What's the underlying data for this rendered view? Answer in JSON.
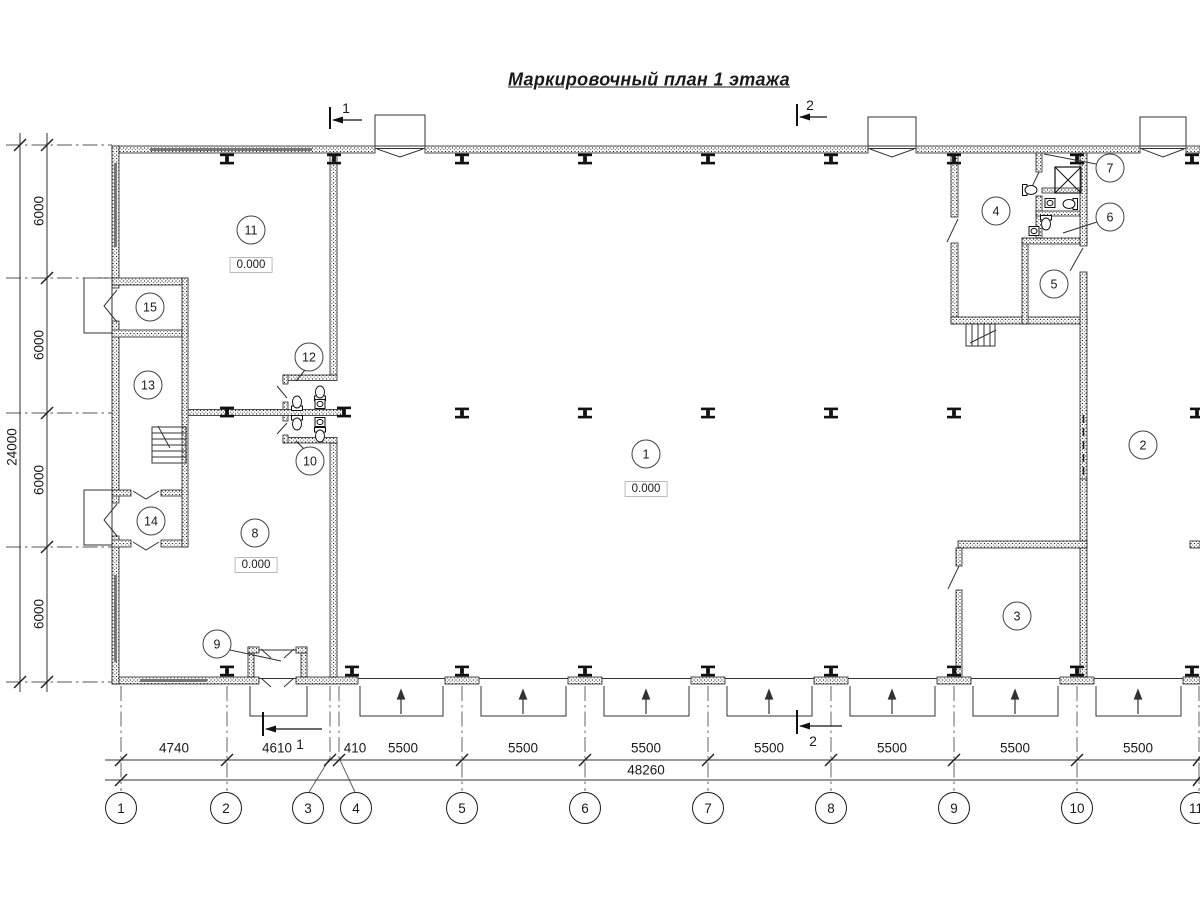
{
  "title": "Маркировочный план 1 этажа",
  "rooms": [
    {
      "number": "1",
      "level": "0.000"
    },
    {
      "number": "2"
    },
    {
      "number": "3"
    },
    {
      "number": "4"
    },
    {
      "number": "5"
    },
    {
      "number": "6"
    },
    {
      "number": "7"
    },
    {
      "number": "8",
      "level": "0.000"
    },
    {
      "number": "9"
    },
    {
      "number": "10"
    },
    {
      "number": "11",
      "level": "0.000"
    },
    {
      "number": "12"
    },
    {
      "number": "13"
    },
    {
      "number": "14"
    },
    {
      "number": "15"
    }
  ],
  "grid": {
    "labels": [
      "1",
      "2",
      "3",
      "4",
      "5",
      "6",
      "7",
      "8",
      "9",
      "10",
      "11"
    ],
    "dims_bottom": [
      "4740",
      "4610",
      "410",
      "5500",
      "5500",
      "5500",
      "5500",
      "5500",
      "5500",
      "5500"
    ],
    "total_bottom": "48260",
    "dims_left": [
      "6000",
      "6000",
      "6000",
      "6000"
    ],
    "total_left": "24000"
  },
  "sections": {
    "top_1": "1",
    "top_2": "2",
    "bottom_1": "1",
    "bottom_2": "2"
  }
}
